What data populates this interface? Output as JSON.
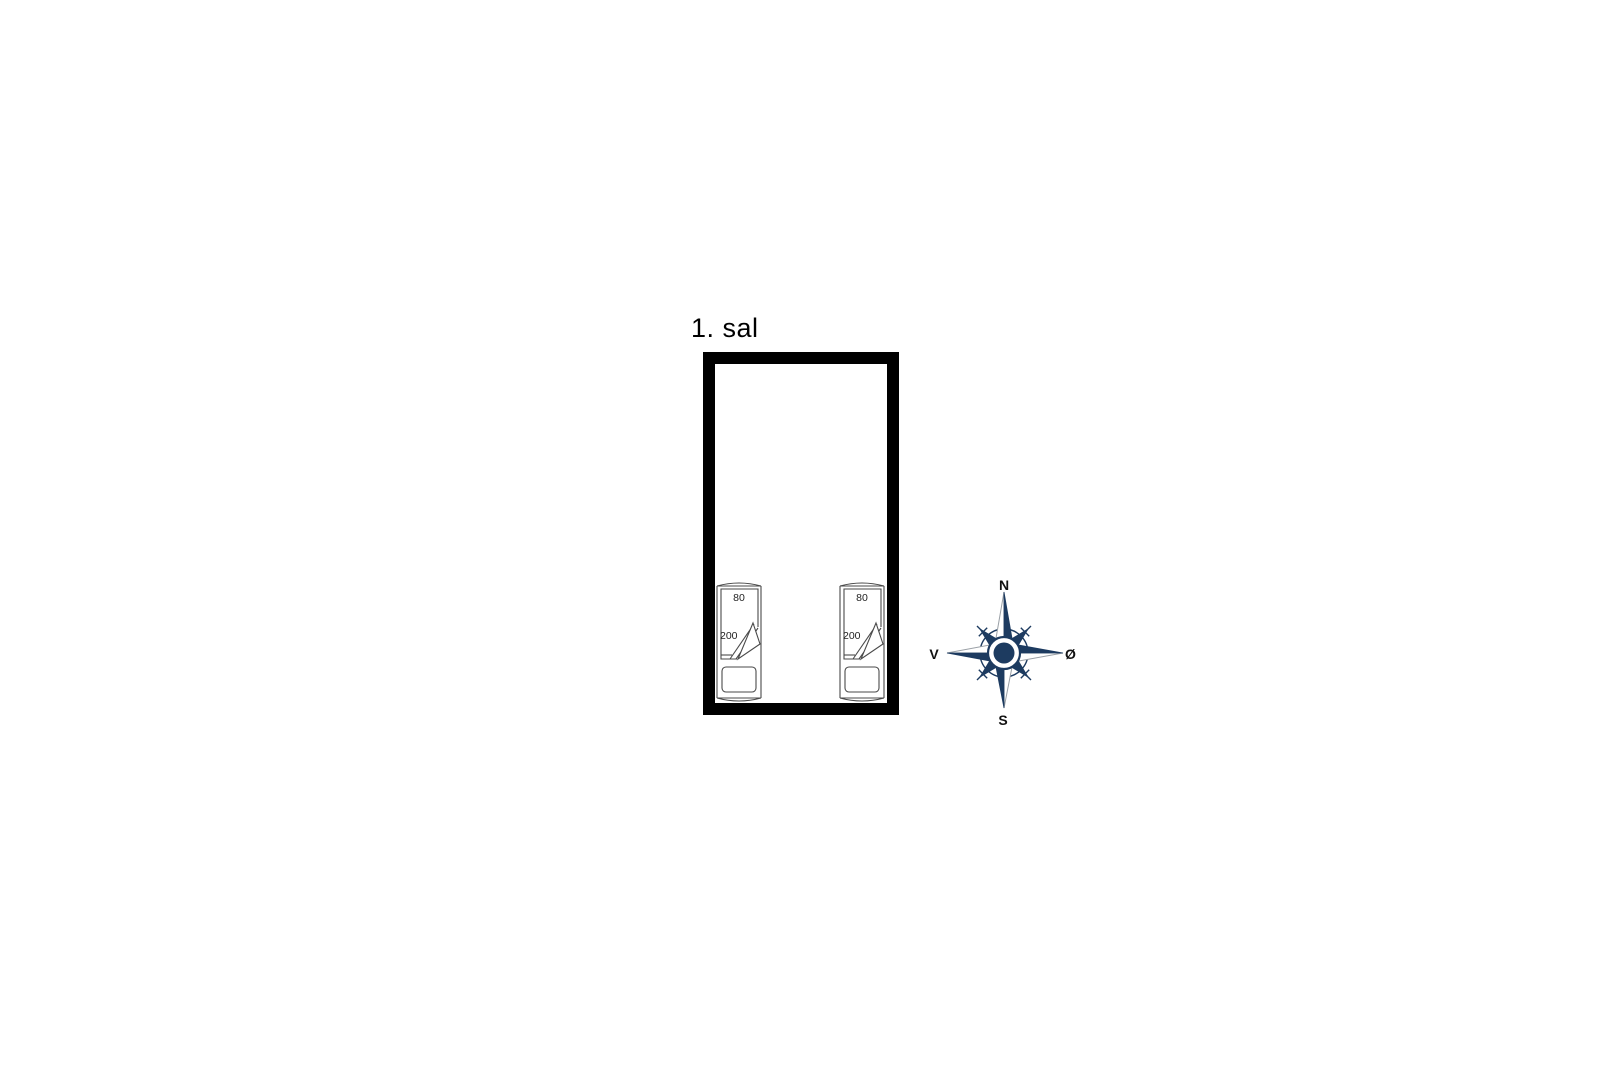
{
  "floor_plan": {
    "title": "1. sal"
  },
  "beds": [
    {
      "width_label": "80",
      "length_label": "200"
    },
    {
      "width_label": "80",
      "length_label": "200"
    }
  ],
  "compass": {
    "north": "N",
    "east": "Ø",
    "south": "S",
    "west": "V"
  },
  "colors": {
    "wall": "#000000",
    "furniture_line": "#4a4a4a",
    "compass_navy": "#1d3b60",
    "compass_light_stroke": "#9aa0a6"
  }
}
